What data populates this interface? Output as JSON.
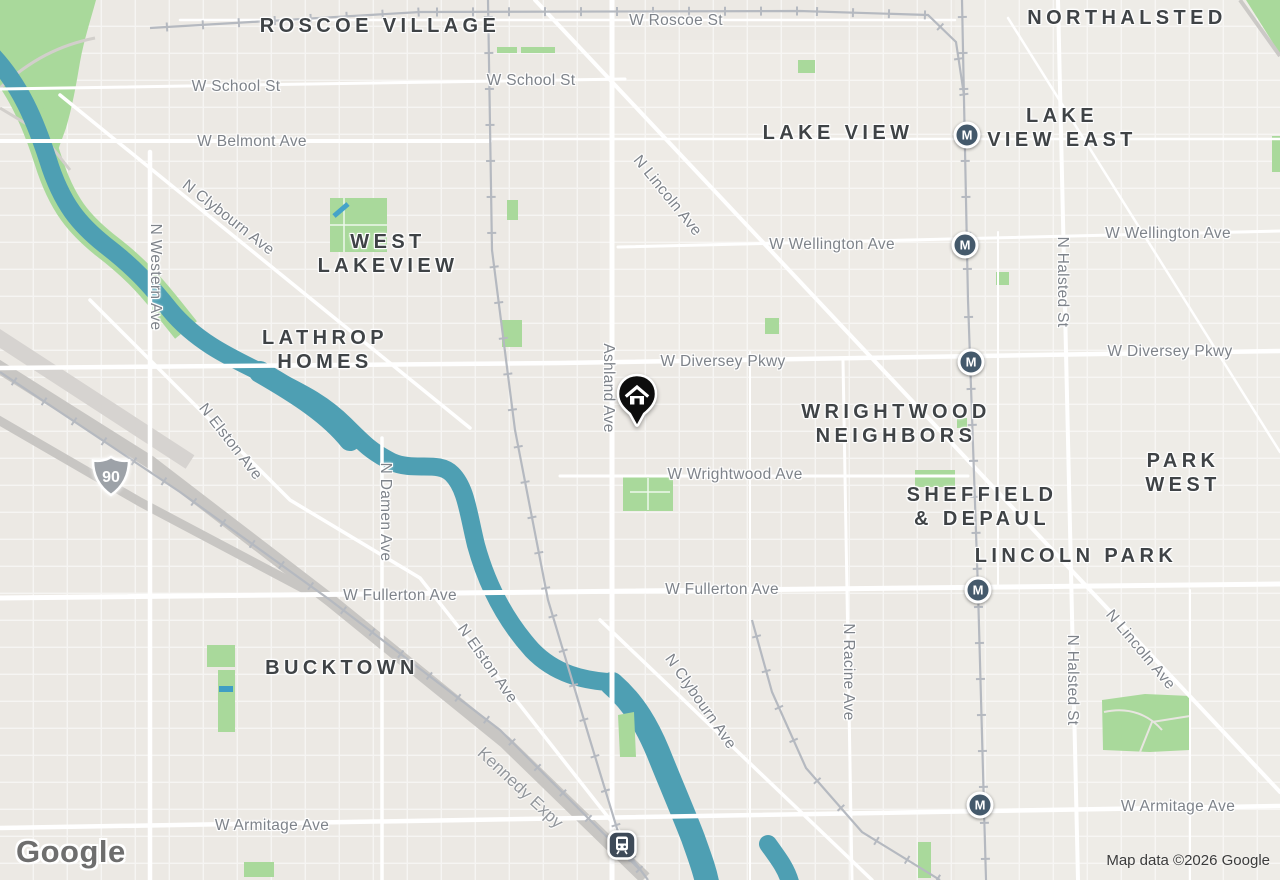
{
  "map": {
    "logo_text": "Google",
    "attribution": "Map data ©2026 Google",
    "colors": {
      "land": "#ece9e4",
      "water": "#4e9fb3",
      "park": "#a9d99b",
      "road": "#ffffff",
      "highway": "#c8c6c3",
      "railway": "#b5b9c0",
      "neighborhood_text": "#3f4346",
      "street_text": "#7e838a",
      "transit_marker": "#44596b",
      "home_marker": "#0d0d0d",
      "shield_gray": "#9da2a8"
    },
    "neighborhood_labels": [
      {
        "text": "ROSCOE VILLAGE",
        "x": 380,
        "y": 26
      },
      {
        "text": "NORTHALSTED",
        "x": 1127,
        "y": 18
      },
      {
        "text": "LAKE VIEW",
        "x": 838,
        "y": 133
      },
      {
        "text": "LAKE\nVIEW EAST",
        "x": 1062,
        "y": 128
      },
      {
        "text": "WEST\nLAKEVIEW",
        "x": 388,
        "y": 254
      },
      {
        "text": "LATHROP\nHOMES",
        "x": 325,
        "y": 350
      },
      {
        "text": "WRIGHTWOOD\nNEIGHBORS",
        "x": 896,
        "y": 424
      },
      {
        "text": "PARK WEST",
        "x": 1183,
        "y": 473
      },
      {
        "text": "SHEFFIELD\n& DEPAUL",
        "x": 982,
        "y": 507
      },
      {
        "text": "LINCOLN PARK",
        "x": 1076,
        "y": 556
      },
      {
        "text": "BUCKTOWN",
        "x": 342,
        "y": 668
      }
    ],
    "street_labels": [
      {
        "text": "W Roscoe St",
        "x": 676,
        "y": 21,
        "rot": 0
      },
      {
        "text": "W School St",
        "x": 236,
        "y": 87,
        "rot": 0
      },
      {
        "text": "W School St",
        "x": 531,
        "y": 81,
        "rot": 0
      },
      {
        "text": "W Belmont Ave",
        "x": 252,
        "y": 142,
        "rot": 0
      },
      {
        "text": "N Clybourn Ave",
        "x": 228,
        "y": 218,
        "rot": 38
      },
      {
        "text": "N Western Ave",
        "x": 155,
        "y": 277,
        "rot": 90
      },
      {
        "text": "N Lincoln Ave",
        "x": 667,
        "y": 196,
        "rot": 51
      },
      {
        "text": "W Wellington Ave",
        "x": 832,
        "y": 245,
        "rot": 0
      },
      {
        "text": "W Wellington Ave",
        "x": 1168,
        "y": 234,
        "rot": 0
      },
      {
        "text": "W Diversey Pkwy",
        "x": 723,
        "y": 362,
        "rot": 0
      },
      {
        "text": "W Diversey Pkwy",
        "x": 1170,
        "y": 352,
        "rot": 0
      },
      {
        "text": "Ashland Ave",
        "x": 608,
        "y": 388,
        "rot": 90
      },
      {
        "text": "W Wrightwood Ave",
        "x": 735,
        "y": 475,
        "rot": 0
      },
      {
        "text": "N Elston Ave",
        "x": 230,
        "y": 442,
        "rot": 52
      },
      {
        "text": "N Damen Ave",
        "x": 385,
        "y": 512,
        "rot": 90
      },
      {
        "text": "W Fullerton Ave",
        "x": 400,
        "y": 596,
        "rot": 0
      },
      {
        "text": "W Fullerton Ave",
        "x": 722,
        "y": 590,
        "rot": 0
      },
      {
        "text": "N Elston Ave",
        "x": 487,
        "y": 664,
        "rot": 55
      },
      {
        "text": "N Clybourn Ave",
        "x": 700,
        "y": 702,
        "rot": 55
      },
      {
        "text": "N Racine Ave",
        "x": 848,
        "y": 672,
        "rot": 90
      },
      {
        "text": "N Halsted St",
        "x": 1062,
        "y": 282,
        "rot": 90
      },
      {
        "text": "N Halsted St",
        "x": 1072,
        "y": 680,
        "rot": 90
      },
      {
        "text": "N Lincoln Ave",
        "x": 1140,
        "y": 650,
        "rot": 50
      },
      {
        "text": "W Armitage Ave",
        "x": 272,
        "y": 826,
        "rot": 0
      },
      {
        "text": "W Armitage Ave",
        "x": 1178,
        "y": 807,
        "rot": 0
      },
      {
        "text": "Kennedy Expy",
        "x": 520,
        "y": 788,
        "rot": 43,
        "type": "highway"
      }
    ],
    "transit_markers": {
      "label": "M",
      "positions": [
        {
          "x": 967,
          "y": 135
        },
        {
          "x": 965,
          "y": 245
        },
        {
          "x": 971,
          "y": 362
        },
        {
          "x": 978,
          "y": 590
        },
        {
          "x": 980,
          "y": 805
        }
      ]
    },
    "train_station_marker": {
      "x": 622,
      "y": 845
    },
    "home_marker": {
      "x": 637,
      "y": 394
    },
    "route_shield": {
      "text": "90",
      "x": 111,
      "y": 476
    }
  }
}
